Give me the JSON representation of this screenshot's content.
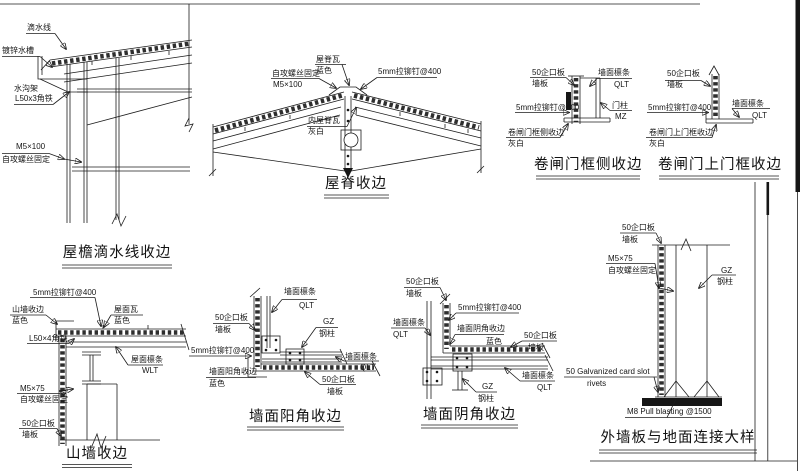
{
  "page": {
    "paper_color": "#ffffff",
    "ink_color": "#1c1c1c"
  },
  "d1": {
    "title": "屋檐滴水线收边",
    "drip": "滴水线",
    "gutter": "镀锌水槽",
    "bracket": "水沟架",
    "angle": "L50x3角铁",
    "screw": "M5×100",
    "fix": "自攻螺丝固定"
  },
  "d2": {
    "title": "屋脊收边",
    "tile": "屋脊瓦",
    "tile_color": "蓝色",
    "fix": "自攻螺丝固定",
    "screw": "M5×100",
    "rivet": "5mm拉铆钉@400",
    "inner": "内屋脊瓦",
    "inner_color": "灰白"
  },
  "d3": {
    "title": "卷闸门框侧收边",
    "board": "50企口板",
    "panel": "墙板",
    "purlin": "墙面檩条",
    "purlin_code": "QLT",
    "rivet": "5mm拉铆钉@400",
    "post": "门柱",
    "post_code": "MZ",
    "trim": "卷闸门框侧收边",
    "trim_color": "灰白"
  },
  "d4": {
    "title": "卷闸门上门框收边",
    "board": "50企口板",
    "panel": "墙板",
    "rivet": "5mm拉铆钉@400",
    "purlin": "墙面檩条",
    "purlin_code": "QLT",
    "trim": "卷闸门上门框收边",
    "trim_color": "灰白"
  },
  "d5": {
    "title": "山墙收边",
    "rivet": "5mm拉铆钉@400",
    "trim": "山墙收边",
    "trim_color": "蓝色",
    "tile": "屋面瓦",
    "tile_color": "蓝色",
    "angle": "L50×4角铁",
    "purlin": "屋面檩条",
    "purlin_code": "WLT",
    "screw": "M5×75",
    "fix": "自攻螺丝固定",
    "board": "50企口板",
    "panel": "墙板"
  },
  "d6": {
    "title": "墙面阳角收边",
    "purlin_top": "墙面檩条",
    "purlin_top_code": "QLT",
    "board_left": "50企口板",
    "panel_left": "墙板",
    "col": "GZ",
    "col_name": "钢柱",
    "rivet": "5mm拉铆钉@400",
    "purlin_right": "墙面檩条",
    "purlin_right_code": "QLT",
    "trim": "墙面阳角收边",
    "trim_color": "蓝色",
    "board_bottom": "50企口板",
    "panel_bottom": "墙板"
  },
  "d7": {
    "title": "墙面阴角收边",
    "board_top": "50企口板",
    "panel_top": "墙板",
    "rivet": "5mm拉铆钉@400",
    "purlin_left": "墙面檩条",
    "purlin_left_code": "QLT",
    "trim": "墙面阴角收边",
    "trim_color": "蓝色",
    "board_right": "50企口板",
    "panel_right": "墙板",
    "col": "GZ",
    "col_name": "钢柱",
    "purlin_bottom": "墙面檩条",
    "purlin_bottom_code": "QLT"
  },
  "d8": {
    "title": "外墙板与地面连接大样",
    "board": "50企口板",
    "panel": "墙板",
    "screw": "M5×75",
    "fix": "自攻螺丝固定",
    "col": "GZ",
    "col_name": "钢柱",
    "slot": "50 Galvanized card slot",
    "rivets": "rivets",
    "anchor": "M8 Pull blasting @1500"
  }
}
